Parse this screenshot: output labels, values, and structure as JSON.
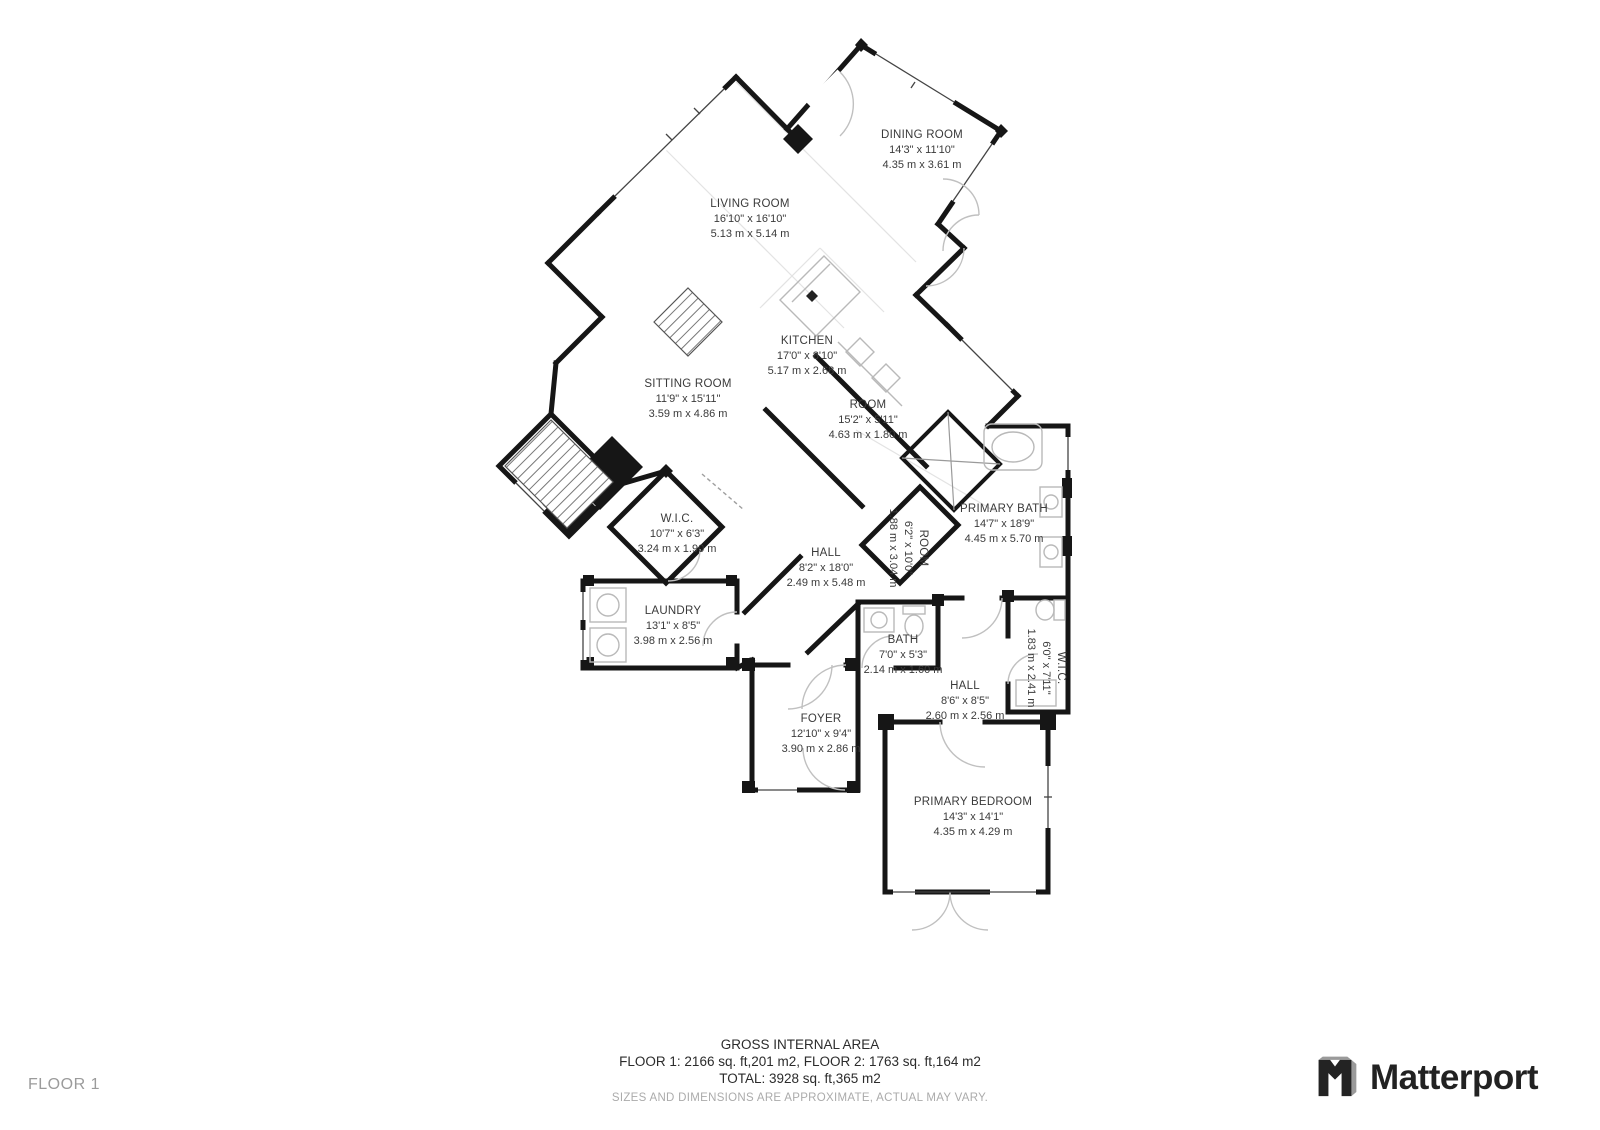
{
  "page": {
    "floor_label": "FLOOR 1",
    "brand": "Matterport"
  },
  "icons": {
    "brand_logo": "matterport-cube-icon"
  },
  "colors": {
    "wall": "#161616",
    "furniture_gray": "#b9b9b9",
    "door_arc_gray": "#c0c0c0",
    "label_text": "#3a3a3a",
    "muted_text": "#ababab"
  },
  "rooms": [
    {
      "id": "dining-room",
      "name": "DINING ROOM",
      "size_ft": "14'3\" x 11'10\"",
      "size_m": "4.35 m x 3.61 m"
    },
    {
      "id": "living-room",
      "name": "LIVING ROOM",
      "size_ft": "16'10\" x 16'10\"",
      "size_m": "5.13 m x 5.14 m"
    },
    {
      "id": "kitchen",
      "name": "KITCHEN",
      "size_ft": "17'0\" x 8'10\"",
      "size_m": "5.17 m x 2.68 m"
    },
    {
      "id": "sitting-room",
      "name": "SITTING ROOM",
      "size_ft": "11'9\" x 15'11\"",
      "size_m": "3.59 m x 4.86 m"
    },
    {
      "id": "room-pantry",
      "name": "ROOM",
      "size_ft": "15'2\" x 5'11\"",
      "size_m": "4.63 m x 1.80 m"
    },
    {
      "id": "primary-bath",
      "name": "PRIMARY BATH",
      "size_ft": "14'7\" x 18'9\"",
      "size_m": "4.45 m x 5.70 m"
    },
    {
      "id": "wic-1",
      "name": "W.I.C.",
      "size_ft": "10'7\" x 6'3\"",
      "size_m": "3.24 m x 1.90 m"
    },
    {
      "id": "hall-1",
      "name": "HALL",
      "size_ft": "8'2\" x 18'0\"",
      "size_m": "2.49 m x 5.48 m"
    },
    {
      "id": "room-small",
      "name": "ROOM",
      "size_ft": "6'2\" x 10'0\"",
      "size_m": "1.88 m x 3.04 m"
    },
    {
      "id": "laundry",
      "name": "LAUNDRY",
      "size_ft": "13'1\" x 8'5\"",
      "size_m": "3.98 m x 2.56 m"
    },
    {
      "id": "bath",
      "name": "BATH",
      "size_ft": "7'0\" x 5'3\"",
      "size_m": "2.14 m x 1.60 m"
    },
    {
      "id": "hall-2",
      "name": "HALL",
      "size_ft": "8'6\" x 8'5\"",
      "size_m": "2.60 m x 2.56 m"
    },
    {
      "id": "wic-2",
      "name": "W.I.C.",
      "size_ft": "6'0\" x 7'11\"",
      "size_m": "1.83 m x 2.41 m"
    },
    {
      "id": "foyer",
      "name": "FOYER",
      "size_ft": "12'10\" x 9'4\"",
      "size_m": "3.90 m x 2.86 m"
    },
    {
      "id": "primary-bedroom",
      "name": "PRIMARY BEDROOM",
      "size_ft": "14'3\" x 14'1\"",
      "size_m": "4.35 m x 4.29 m"
    }
  ],
  "footer": {
    "title": "GROSS INTERNAL AREA",
    "line1": "FLOOR 1: 2166 sq. ft,201 m2, FLOOR 2: 1763 sq. ft,164 m2",
    "line2": "TOTAL: 3928 sq. ft,365 m2",
    "disclaimer": "SIZES AND DIMENSIONS ARE APPROXIMATE, ACTUAL MAY VARY."
  }
}
